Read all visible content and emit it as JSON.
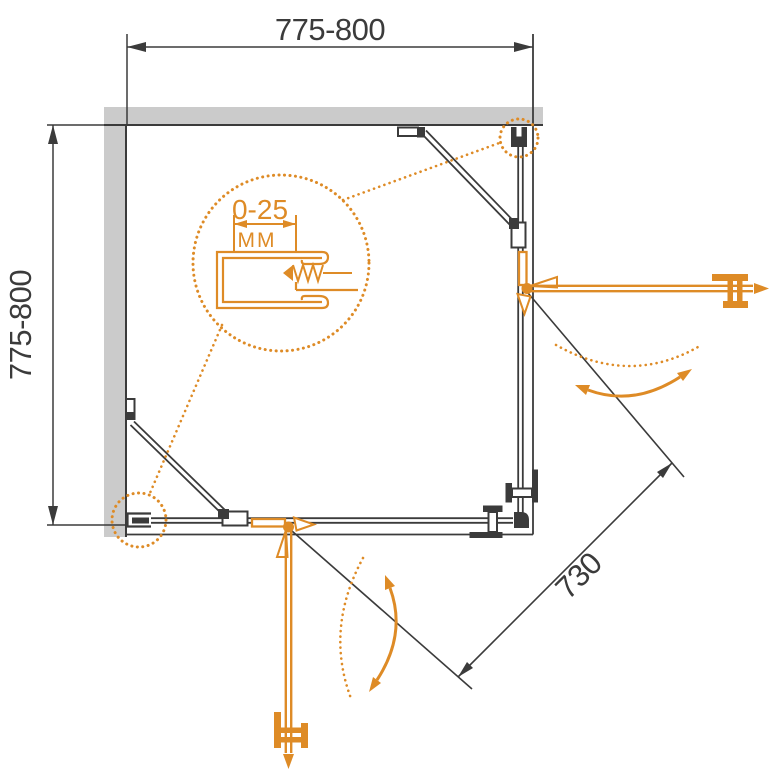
{
  "diagram": {
    "dimensions": {
      "top": {
        "label": "775-800"
      },
      "left": {
        "label": "775-800"
      },
      "diagonal": {
        "label": "730"
      }
    },
    "detail_callout": {
      "range_label": "0-25",
      "unit_label": "MM"
    },
    "colors": {
      "accent_orange": "#DE8B26",
      "wall_gray": "#CBCBCB",
      "line_dark": "#3B3B3B"
    }
  }
}
